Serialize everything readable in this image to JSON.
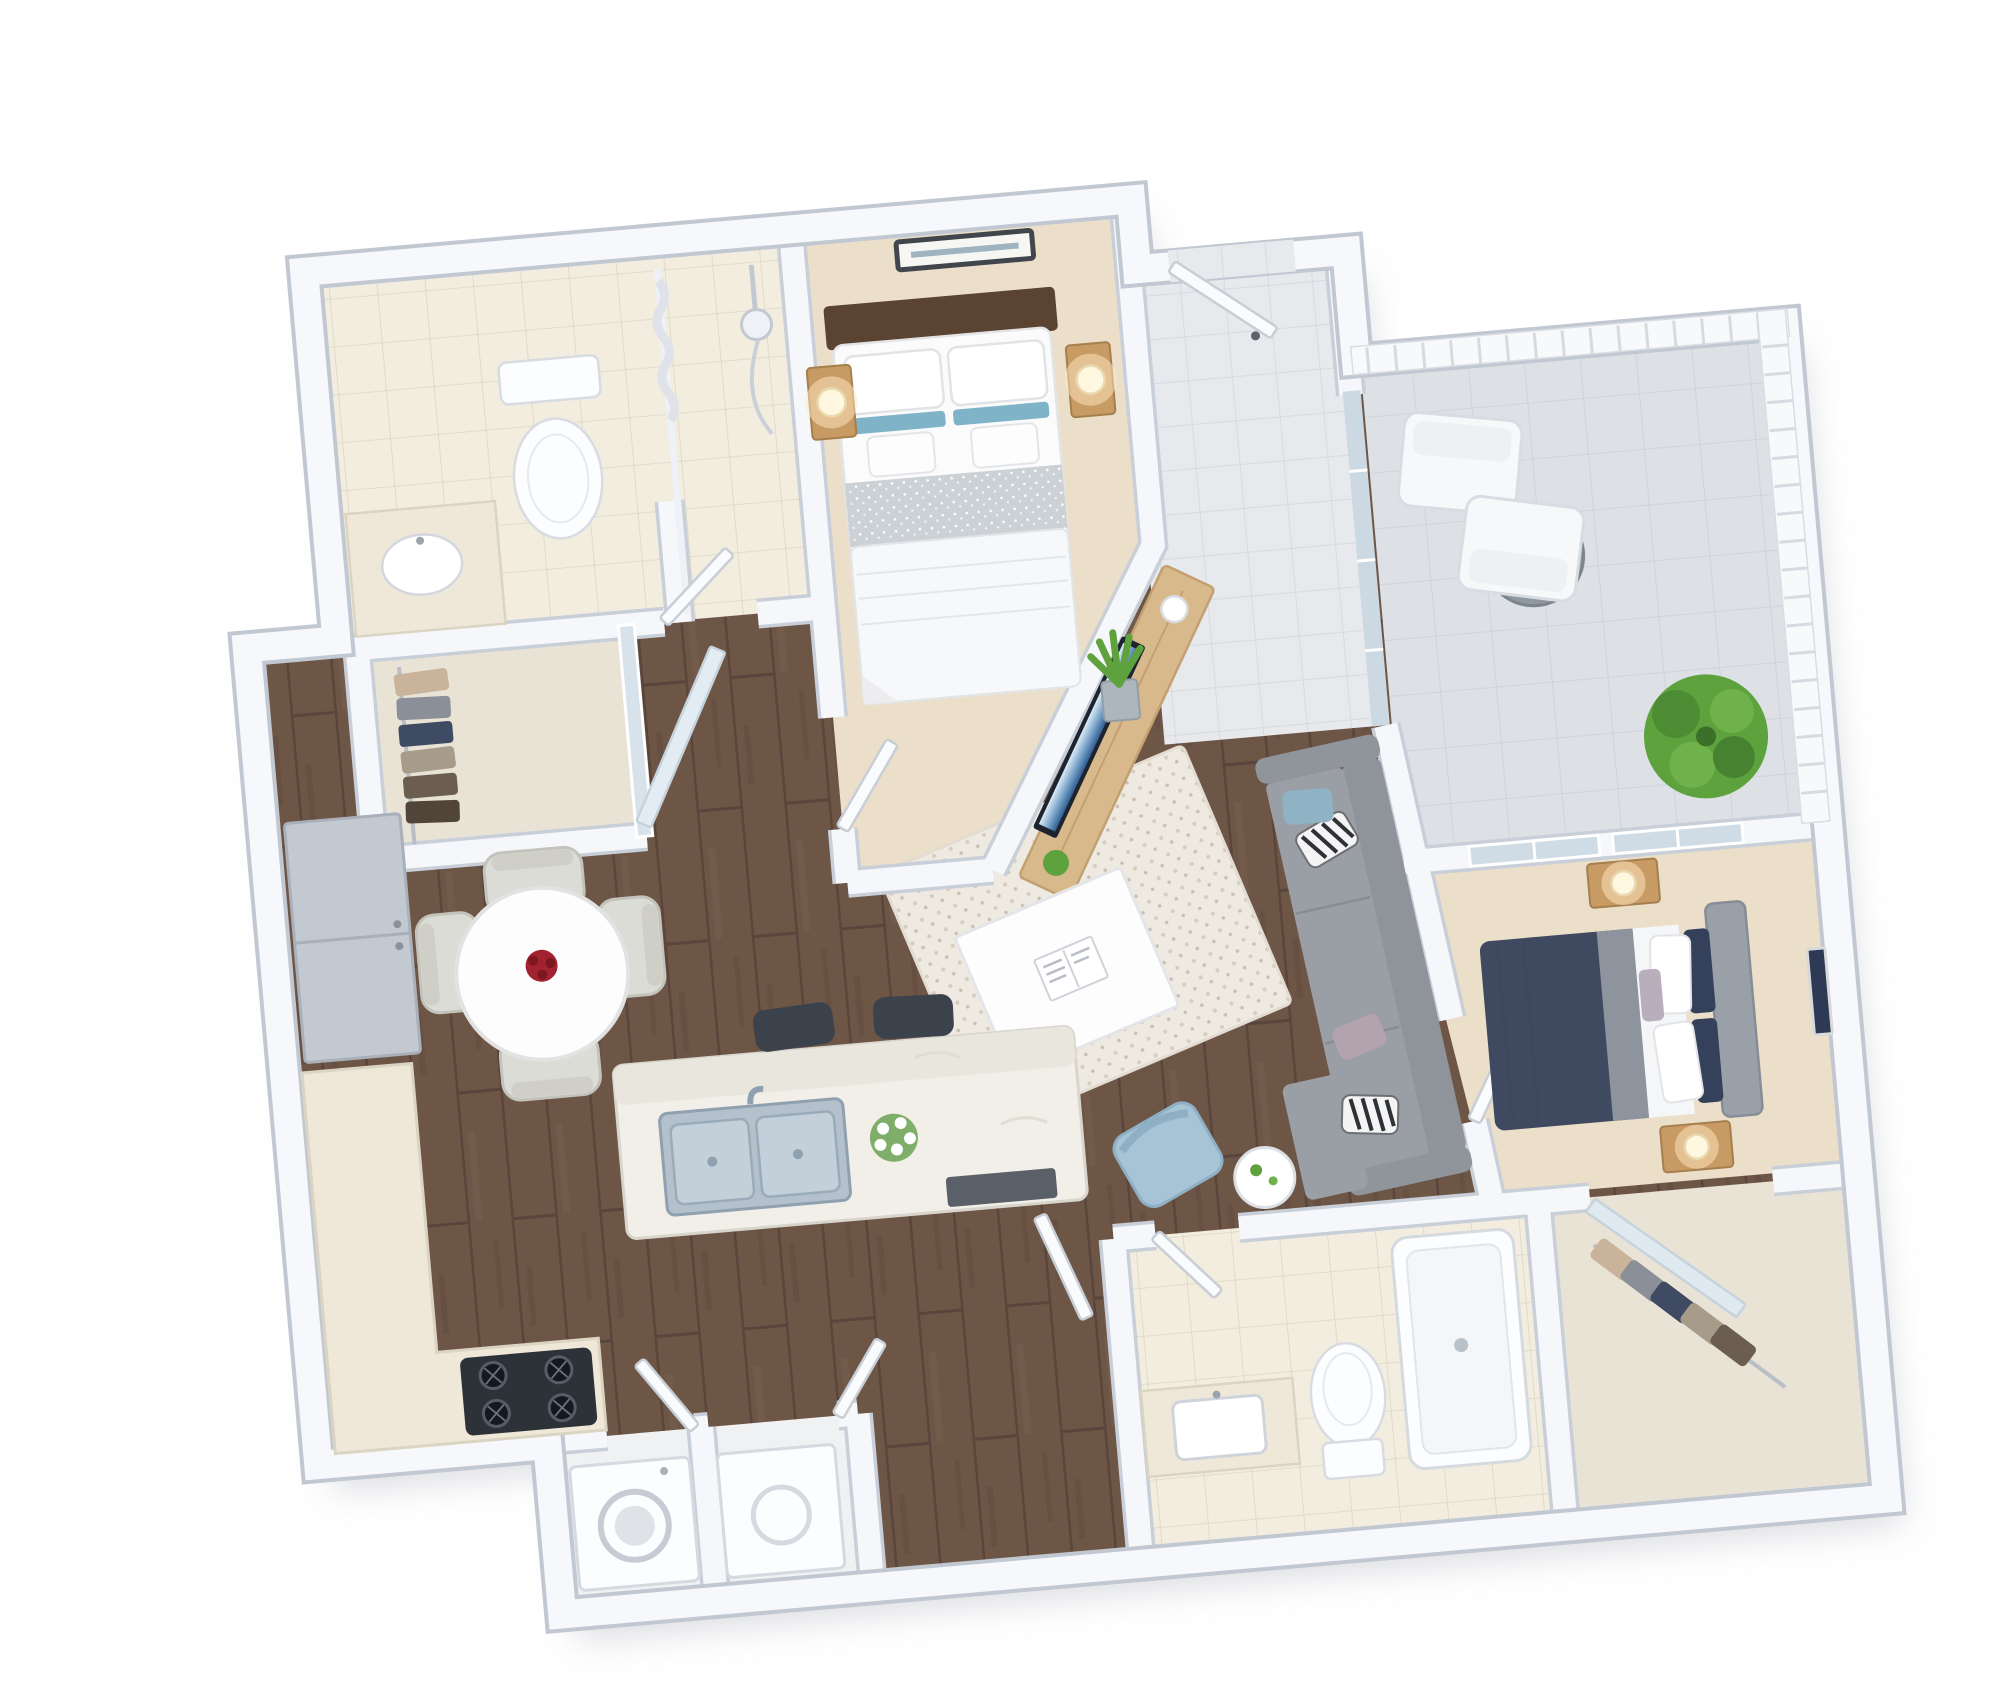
{
  "meta": {
    "type": "3D floor plan rendering",
    "view": "isometric top-down",
    "bedrooms": 2,
    "bathrooms": 2,
    "has_balcony": true
  },
  "palette": {
    "background": "#ffffff",
    "wall": "#f5f7fa",
    "wall_edge": "#c9cfd8",
    "wood_floor": "#6e5647",
    "carpet": "#ecdfc9",
    "tile_bath": "#f2edde",
    "tile_entry": "#e7e9ed",
    "tile_balcony": "#dde0e5",
    "rug": "#efeae1",
    "sofa": "#9a9ea5",
    "accent_chair": "#a7c4d6",
    "bed2_duvet": "#3f4a61",
    "headboard_wood": "#5b4332",
    "nightstand_wood": "#c89a64",
    "lamp_glow": "#ffe9c4",
    "plant_green": "#5ea23e",
    "counter": "#efe8d8",
    "marble": "#f1efe7",
    "appliance_gray": "#c3c9d1",
    "cooktop_black": "#2d3138",
    "sink_steel": "#b4c1cd",
    "flower_red": "#a32230",
    "mirror_blue": "#d7e2ea",
    "tv_screen_blue": "#3a6ea8"
  },
  "rooms": [
    {
      "id": "master-bathroom",
      "name": "Master Bathroom",
      "floor": "tile",
      "furniture": [
        "toilet",
        "walk-in shower",
        "shower curtain",
        "vanity sink"
      ]
    },
    {
      "id": "master-closet",
      "name": "Walk-in Closet",
      "floor": "carpet",
      "furniture": [
        "hanging clothes",
        "mirrored sliding door"
      ]
    },
    {
      "id": "master-bedroom",
      "name": "Master Bedroom",
      "floor": "carpet",
      "furniture": [
        "queen bed",
        "wood headboard",
        "blue striped pillows",
        "2 nightstands",
        "2 lit table lamps",
        "framed wall art"
      ]
    },
    {
      "id": "entry-hall",
      "name": "Entry Hall",
      "floor": "tile",
      "furniture": [
        "front door",
        "glass partition"
      ]
    },
    {
      "id": "balcony",
      "name": "Balcony",
      "floor": "outdoor tile",
      "furniture": [
        "2 white lounge chairs",
        "round bistro table",
        "large potted plant",
        "white railing"
      ]
    },
    {
      "id": "living-room",
      "name": "Living Room",
      "floor": "hardwood",
      "furniture": [
        "gray sectional sofa",
        "zebra throw pillows",
        "white coffee table",
        "open magazine",
        "speckled area rug",
        "blue accent chair",
        "round side table",
        "wall-mounted tv",
        "wood media console",
        "snake plant"
      ]
    },
    {
      "id": "dining-area",
      "name": "Dining Area",
      "floor": "hardwood",
      "furniture": [
        "round white dining table",
        "red flower centerpiece",
        "4 upholstered chairs",
        "2 framed pictures"
      ]
    },
    {
      "id": "kitchen",
      "name": "Kitchen",
      "floor": "hardwood",
      "furniture": [
        "refrigerator",
        "l-shaped counter",
        "gas cooktop",
        "kitchen island",
        "double stainless sink",
        "faucet",
        "white flower vase",
        "dishwasher",
        "2 bar stools"
      ]
    },
    {
      "id": "laundry-closet",
      "name": "Laundry Closet",
      "floor": "tile",
      "furniture": [
        "washer",
        "dryer"
      ]
    },
    {
      "id": "hallway",
      "name": "Hallway",
      "floor": "hardwood",
      "furniture": [
        "open doors"
      ]
    },
    {
      "id": "second-bathroom",
      "name": "Second Bathroom",
      "floor": "tile",
      "furniture": [
        "vanity sink",
        "toilet",
        "bathtub"
      ]
    },
    {
      "id": "second-bedroom",
      "name": "Second Bedroom",
      "floor": "carpet",
      "furniture": [
        "queen bed with navy duvet",
        "gray upholstered headboard",
        "patterned pillows",
        "2 nightstands",
        "2 lit table lamps",
        "window to balcony",
        "framed wall art"
      ]
    },
    {
      "id": "second-closet",
      "name": "Bedroom Closet",
      "floor": "carpet",
      "furniture": [
        "hanging clothes",
        "mirrored sliding door"
      ]
    }
  ]
}
